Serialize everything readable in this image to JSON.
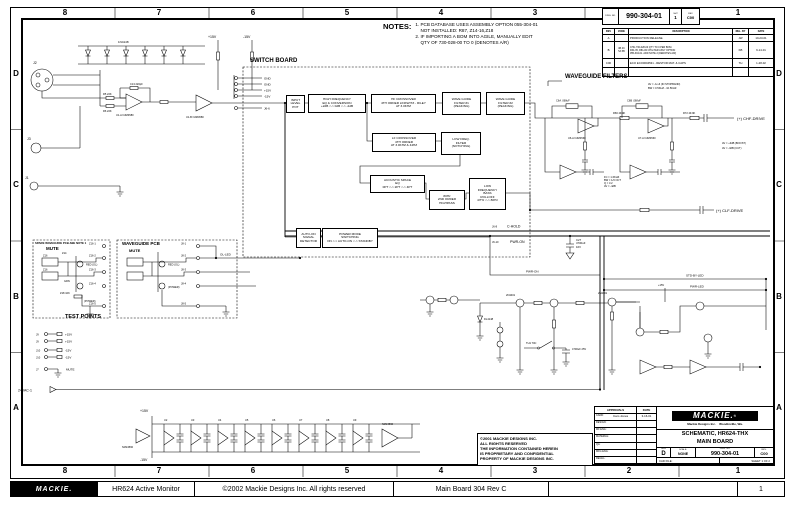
{
  "zones": {
    "columns": [
      "8",
      "7",
      "6",
      "5",
      "4",
      "3",
      "2",
      "1"
    ],
    "rows": [
      "D",
      "C",
      "B",
      "A"
    ]
  },
  "footer": {
    "logo": "MACKIE.",
    "product": "HR624 Active Monitor",
    "copyright": "©2002 Mackie Designs Inc. All rights reserved",
    "board": "Main Board 304 Rev C",
    "page": "1"
  },
  "notes": {
    "heading": "NOTES:",
    "lines": [
      "1. PCB DATABASE USES ASSEMBLY OPTION 055-304-01",
      "    NOT INSTALLED: R87, Z14-16,Z18",
      "2. IF IMPORTING A BOM INTO AGILE, MANUALLY EDIT",
      "    QTY OF 730-028-00 TO 0 (DENOTES A/R)"
    ]
  },
  "doc_block": {
    "dwg_label": "DWG. NO.",
    "number": "990-304-01",
    "sheet_label": "SHT",
    "sheet": "1",
    "rev_label": "REV",
    "rev": "C00"
  },
  "rev_table": {
    "col_rev": "REV",
    "col_zone": "ZONE",
    "col_desc": "DESCRIPTION",
    "col_by": "REL. BY",
    "col_date": "DATE",
    "rows": [
      {
        "rev": "A",
        "zone": "",
        "desc": "PRODUCTION RELEASE.",
        "by": "JW",
        "date": "10-23-01"
      },
      {
        "rev": "B",
        "zone": "4B 4C\n5A 5B",
        "desc": "CHG 730-028-00 QTY TO 0 PER BOM.\nR34-35, R81-82 CHG PER ASSY OPTION\n055-304-01. ADD NOTE 2 (DENOTES A/R)",
        "by": "KB",
        "date": "9-14-01"
      },
      {
        "rev": "C00",
        "zone": "",
        "desc": "ECO ECO0004531 - RESTOR MAT. & CAPS",
        "by": "TH",
        "date": "1-28-02"
      }
    ]
  },
  "title_block": {
    "approvals": "APPROVALS",
    "date": "DATE",
    "rows": [
      [
        "CADD:",
        "Cam Jones",
        "3-16-01"
      ],
      [
        "DESIGN:",
        "",
        ""
      ],
      [
        "MF ENG:",
        "",
        ""
      ],
      [
        "MATERIAL:",
        "",
        ""
      ],
      [
        "QA:",
        "",
        ""
      ],
      [
        "MFG ENG:",
        "",
        ""
      ],
      [
        "REGUL:",
        "",
        ""
      ]
    ],
    "logo": "MACKIE.",
    "reg": "®",
    "company": "Mackie Designs Inc.    Woodinville, Wa.",
    "title1": "SCHEMATIC, HR624-THX",
    "title2": "MAIN BOARD",
    "size_label": "SIZE",
    "size": "D",
    "scale_label": "SCALE:",
    "scale": "NONE",
    "dwg_label": "DWG. NO.",
    "number": "990-304-01",
    "rev_label": "REV.",
    "rev": "C00",
    "cad_label": "CAD FILE:",
    "sheet": "SHEET  1 OF 2"
  },
  "copyright": {
    "lines": [
      "©2001 MACKIE DESIGNS INC.",
      "ALL RIGHTS RESERVED",
      "THE INFORMATION CONTAINED HEREIN",
      "IS PROPRIETARY AND CONFIDENTIAL",
      "PROPERTY OF MACKIE DESIGNS INC."
    ]
  },
  "sections": {
    "switch_board": "SWITCH BOARD",
    "waveguide_filters": "WAVEGUIDE FILTERS",
    "spare_pcb": "SPARE WAVEGUIDE PCB-SEE NOTE 1",
    "spare_mute": "MUTE",
    "waveguide_pcb": "WAVEGUIDE PCB",
    "wg_mute": "MUTE",
    "test_points": "TEST POINTS"
  },
  "blocks": [
    {
      "text": [
        "INPUT",
        "LEVEL",
        "POT"
      ]
    },
    {
      "text": [
        "HIGH FREQUENCY",
        "EQ & CONVERSION",
        "+2dB <-> 0dB <-> -2dB"
      ]
    },
    {
      "text": [
        "HF CROSSOVER",
        "4TH ORDER LINKWITZ - RILEY",
        "AT 3.0KHZ"
      ]
    },
    {
      "text": [
        "WAVE GUIDE",
        "FILTER #1",
        "(PEAKING)"
      ]
    },
    {
      "text": [
        "WAVE GUIDE",
        "FILTER #2",
        "(PEAKING)"
      ]
    },
    {
      "text": [
        "LF CROSSOVER",
        "4TH ORDER",
        "AT 3.0KHZ & 44HZ"
      ]
    },
    {
      "text": [
        "LOW FREQ.",
        "FILTER",
        "(NOTCHING)"
      ]
    },
    {
      "text": [
        "ACOUSTIC SPACE",
        "EQ",
        "0PT <-> 2PT <-> 4PT"
      ]
    },
    {
      "text": [
        "80Hz",
        "2ND ORDER",
        "HIGHPASS"
      ]
    },
    {
      "text": [
        "LOW",
        "FREQUENCY",
        "BASS",
        "ROLLOFF",
        "47Hz <-> 80Hz"
      ]
    },
    {
      "text": [
        "AUTO-ON",
        "SIGNAL",
        "DETECTOR"
      ]
    },
    {
      "text": [
        "POWER MODE",
        "SWITCHING",
        "ON <-> AUTO-ON <-> STANDBY"
      ]
    }
  ],
  "pins": {
    "switch_left": [
      "GND",
      "GND",
      "+15V",
      "-15V"
    ],
    "j6": "J6-6",
    "spare": [
      "Z16-1",
      "Z16-2",
      "Z16-3",
      "Z16-4",
      "Z16-5"
    ],
    "wg": [
      "J8-1",
      "J8-2",
      "J8-3",
      "J8-4",
      "J8-5"
    ],
    "tp_rows": [
      {
        "pin": "J9",
        "net": "+15V"
      },
      {
        "pin": "J9",
        "net": "+15V"
      },
      {
        "pin": "J10",
        "net": "-15V"
      },
      {
        "pin": "J10",
        "net": "-15V"
      }
    ],
    "j7": "J7",
    "j7_net": "MUTE",
    "vac": "24VAC-1"
  },
  "nets": {
    "chf": "(+)  CHF-DRIVE",
    "clf": "(+)  CLF-DRIVE",
    "j6_8": "J6-8",
    "c_hold": "C-HOLD",
    "j6_10": "J6-10",
    "pwr_on": "PWR-ON",
    "pwr_on2": "PWR-ON",
    "std_by_led": "STD-BY-LED",
    "pwr_led": "PWR-LED",
    "ol_led": "OL-LED",
    "p15": "+15V",
    "m15": "-15V",
    "p15_rail": "+15V",
    "m15_rail": "-15V",
    "p15_pwr": "+15V"
  },
  "parts": {
    "j2": "J2",
    "j3": "J3",
    "j1": "J1",
    "d_row": "1N4148",
    "r5": "R5 22K",
    "r6": "R6 22K",
    "c13": "C13 220pF",
    "u1a": "U1-A NJM4580",
    "u1b": "U1-B NJM4580",
    "c6a": "C6A .068uF",
    "c6b": "C6B .068uF",
    "r66": "R66 49.9K",
    "r72": "R72 49.9K",
    "u6a": "U6-A NJM4560",
    "u7a": "U7-A NJM4560",
    "av_note1": "AV = -1/+6 (IN STOPBAND)",
    "av_note2": "BW = 0.5KHZ - 10.5KHZ",
    "boost": "AV = +3dB (BOOST)",
    "cut": "AV = -3dB (CUT)",
    "fn": [
      "FC = 1.6KHZ",
      "BW = 1/3 OCT",
      "Q = 3.2",
      "AV = -4dB"
    ],
    "c27": [
      "C27",
      "4700uF",
      "16V"
    ],
    "q_a": "2N4401",
    "q_b": "2N4401",
    "dl": "DL4148",
    "th": "TH1 70C",
    "c28": "4700uF 25V",
    "z16a": "Z16",
    "z16b": "Z16",
    "z14": "Z14",
    "red_ol": "RED  (OL)",
    "grn": "GRN",
    "z18": "Z18 10K",
    "power": "(POWER)",
    "red_ol2": "RED  (OL)",
    "power2": "(POWER)",
    "u_rail_l": "NJM4560",
    "u_rail_r": "NJM4560",
    "rail_units": [
      "U2",
      "U3",
      "U4",
      "U5",
      "U6",
      "U7",
      "U8",
      "U9"
    ]
  }
}
